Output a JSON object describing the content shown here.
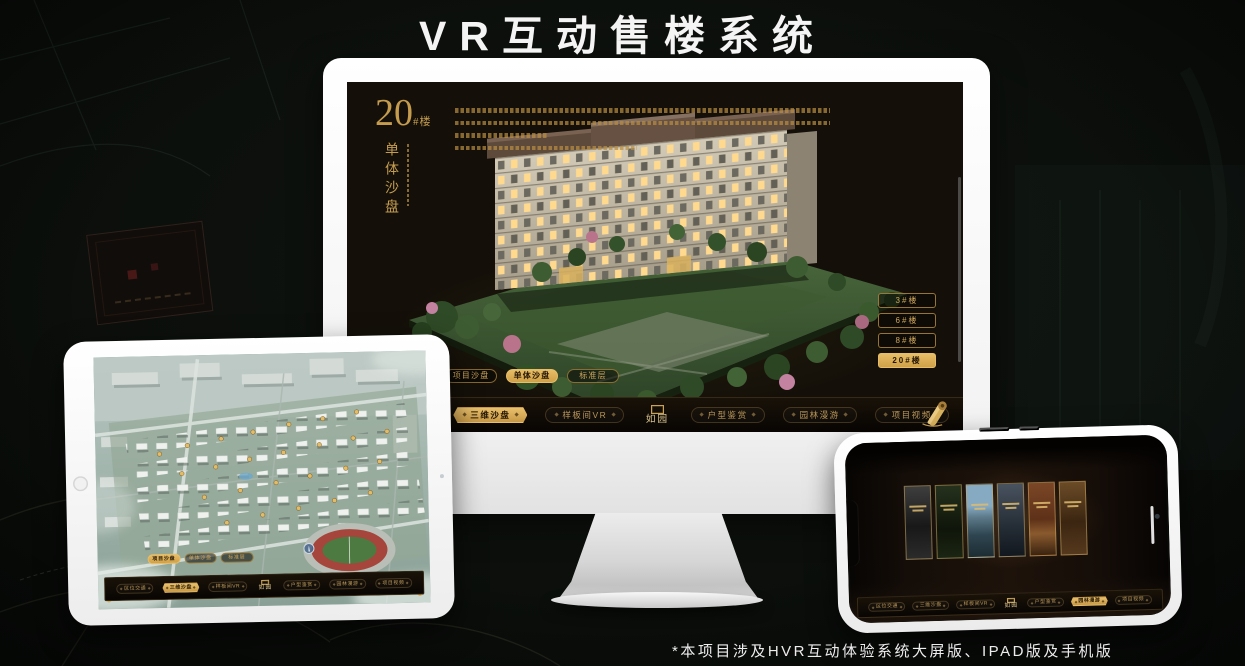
{
  "page": {
    "title": "VR互动售楼系统",
    "footnote": "*本项目涉及HVR互动体验系统大屏版、IPAD版及手机版"
  },
  "brand": {
    "logo": "如园"
  },
  "colors": {
    "gold": "#c9a258",
    "gold_active": "#ddb464",
    "screen_bg": "#141009",
    "menu_text": "#b9975a"
  },
  "monitor": {
    "headline": {
      "number": "20",
      "suffix": "#楼",
      "subtitle": "单体沙盘"
    },
    "building_buttons": [
      {
        "label": "3#楼",
        "active": false
      },
      {
        "label": "6#楼",
        "active": false
      },
      {
        "label": "8#楼",
        "active": false
      },
      {
        "label": "20#楼",
        "active": true
      }
    ],
    "view_tabs": [
      {
        "label": "项目沙盘",
        "active": false
      },
      {
        "label": "单体沙盘",
        "active": true
      },
      {
        "label": "标准层",
        "active": false
      }
    ],
    "menu": {
      "items": [
        {
          "label": "区位交通",
          "active": false
        },
        {
          "label": "三维沙盘",
          "active": true
        },
        {
          "label": "样板间VR",
          "active": false
        },
        {
          "label": "户型鉴赏",
          "active": false
        },
        {
          "label": "园林漫游",
          "active": false
        },
        {
          "label": "项目视频",
          "active": false
        }
      ]
    }
  },
  "tablet": {
    "view_tabs": [
      {
        "label": "项目沙盘",
        "active": true
      },
      {
        "label": "单体沙盘",
        "active": false
      },
      {
        "label": "标准层",
        "active": false
      }
    ],
    "menu": {
      "items": [
        {
          "label": "区位交通",
          "active": false
        },
        {
          "label": "三维沙盘",
          "active": true
        },
        {
          "label": "样板间VR",
          "active": false
        },
        {
          "label": "户型鉴赏",
          "active": false
        },
        {
          "label": "园林漫游",
          "active": false
        },
        {
          "label": "项目视频",
          "active": false
        }
      ]
    }
  },
  "phone": {
    "menu": {
      "items": [
        {
          "label": "区位交通",
          "active": false
        },
        {
          "label": "三维沙盘",
          "active": false
        },
        {
          "label": "样板间VR",
          "active": false
        },
        {
          "label": "户型鉴赏",
          "active": false
        },
        {
          "label": "园林漫游",
          "active": true
        },
        {
          "label": "项目视频",
          "active": false
        }
      ]
    }
  }
}
